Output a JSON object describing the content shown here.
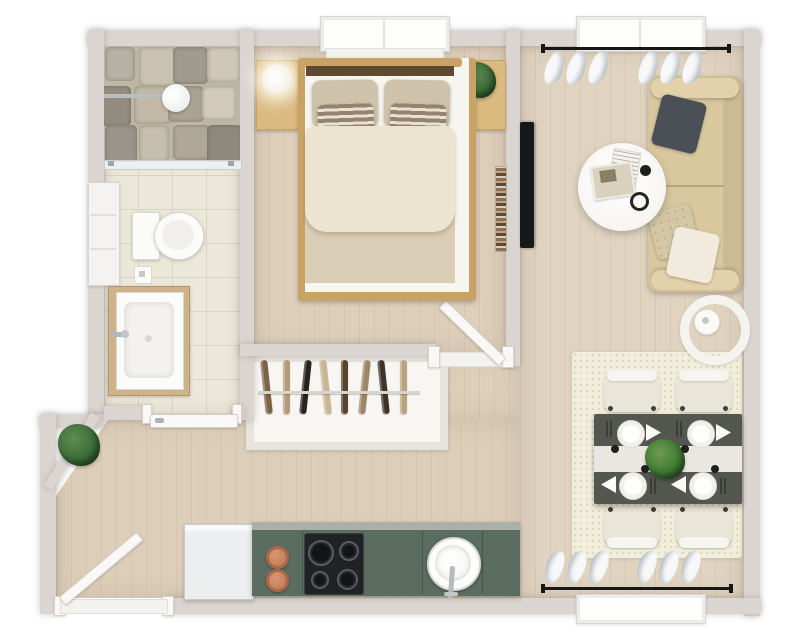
{
  "scene": {
    "type": "floor-plan",
    "view": "3d-top-down-render",
    "description": "3D rendered top-down floor plan of a one-bedroom apartment with bathroom, bedroom, closet, living room, dining area, kitchen and entry hall"
  },
  "palette": {
    "wall": "#dbd5d1",
    "wood_floor": "#decfbb",
    "tile_floor": "#ebe7d9",
    "rug": "#f2eedc",
    "kitchen_counter": "#5b6c61",
    "sofa": "#d9c79e",
    "dining_table": "#53574f",
    "bed_frame": "#c9a266",
    "duvet": "#ece3d0",
    "plant_green": "#3c6d38",
    "tv_black": "#17181a",
    "copper_pot": "#c5805c",
    "curtain": "#f0f2f3",
    "curtain_rod": "#161616"
  },
  "rooms": [
    {
      "name": "bathroom",
      "furniture": [
        "walk-in shower with stone floor",
        "rain shower head",
        "glass divider",
        "toilet",
        "vanity with sink and faucet",
        "tall storage cabinet",
        "tiled floor"
      ]
    },
    {
      "name": "bedroom",
      "furniture": [
        "double bed with cream duvet",
        "two striped accent pillows",
        "nightstand with glowing lamp",
        "nightstand with plant",
        "wall bookshelf",
        "window"
      ]
    },
    {
      "name": "closet",
      "furniture": [
        "built-in wardrobe with clothes rail"
      ]
    },
    {
      "name": "living-room",
      "furniture": [
        "three-seat tan sofa",
        "gray throw pillow",
        "floral throw pillow",
        "white throw pillow",
        "round white coffee table with magazines and cup",
        "wall-mounted tv",
        "arc floor lamp",
        "curtained window"
      ]
    },
    {
      "name": "dining-area",
      "furniture": [
        "dark table for four with white runner",
        "four chairs",
        "four place settings",
        "green centerpiece",
        "textured cream rug",
        "curtained window"
      ]
    },
    {
      "name": "kitchen",
      "furniture": [
        "refrigerator",
        "green counter with cabinets",
        "four-burner cooktop",
        "two copper pots",
        "round sink with faucet"
      ]
    },
    {
      "name": "entry-hall",
      "furniture": [
        "open entry door",
        "corner plant nook",
        "diagonal wall"
      ]
    }
  ],
  "counts": {
    "dining_plates": 4,
    "dining_chairs": 4,
    "stove_burners": 4,
    "closet_hangers": 8,
    "curtain_pleats_per_group": 3,
    "curtain_groups_per_window": 2,
    "windows": 3,
    "doors": 3
  },
  "closet": {
    "hanger_colors": [
      "#7d6347",
      "#b59a77",
      "#26221e",
      "#c8b592",
      "#58452f",
      "#9c8664",
      "#3e342a",
      "#baa27e"
    ]
  },
  "shower": {
    "stone_colors": [
      "#b7b1a3",
      "#c9c2b1",
      "#a19b8d",
      "#cfc8b6",
      "#938d7f",
      "#c1b9a6",
      "#aaa393",
      "#d2cbba",
      "#9b948a",
      "#c6bfae",
      "#b0a896",
      "#8f897c"
    ]
  }
}
